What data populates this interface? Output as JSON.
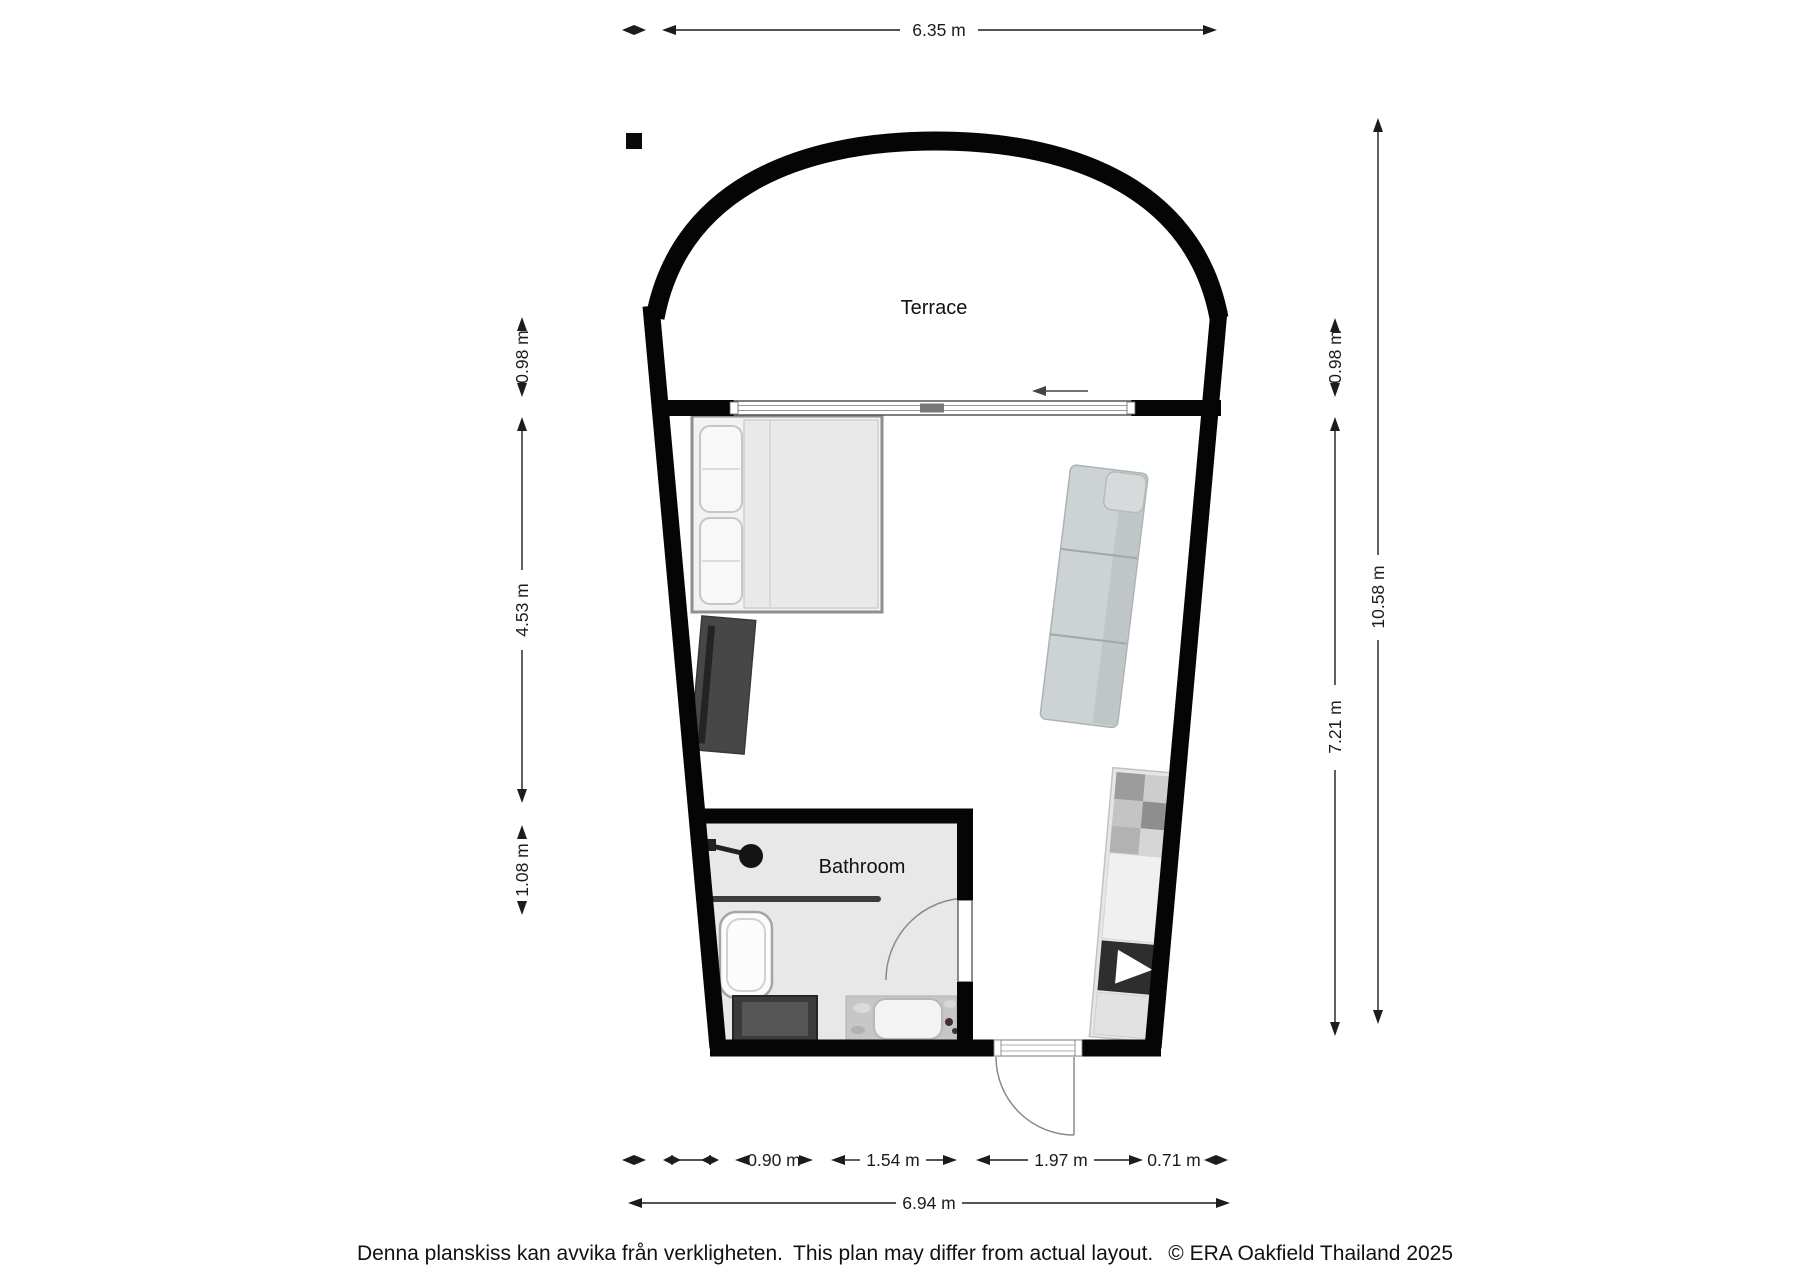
{
  "floorplan": {
    "rooms": {
      "terrace": "Terrace",
      "bathroom": "Bathroom"
    },
    "dimensions": {
      "top_width": "6.35 m",
      "left": [
        "0.98 m",
        "4.53 m",
        "1.08 m"
      ],
      "right": [
        "0.98 m",
        "7.21 m"
      ],
      "total_height": "10.58 m",
      "bottom_segments": [
        "0.90 m",
        "1.54 m",
        "1.97 m",
        "0.71 m"
      ],
      "bottom_total": "6.94 m"
    },
    "footer": {
      "disclaimer_sv": "Denna planskiss kan avvika från verkligheten.",
      "disclaimer_en": "This plan may differ from actual layout.",
      "copyright": "© ERA Oakfield Thailand 2025"
    },
    "colors": {
      "wall": "#050505",
      "bathroom_floor": "#e8e8e8",
      "dimension_text": "#1c1c1c"
    }
  }
}
